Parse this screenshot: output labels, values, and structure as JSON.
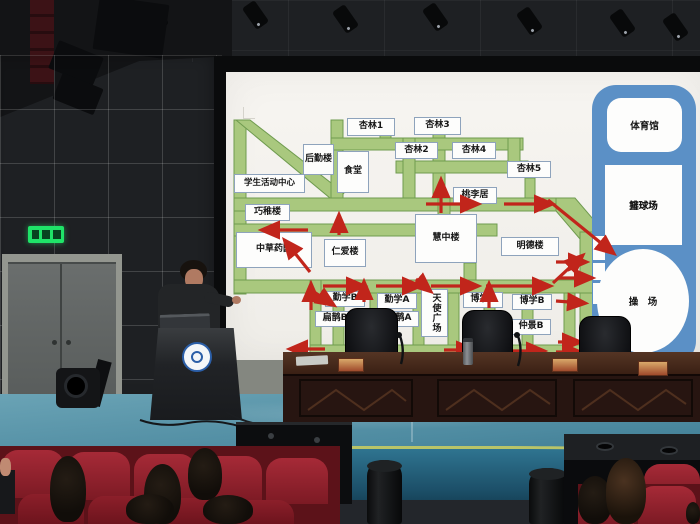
{
  "colors": {
    "road": "#a9c87e",
    "road_border": "#6f9b4f",
    "route_arrow": "#c1251b",
    "sports_panel_blue": "#5b90c6",
    "label_border": "#8ea3bc",
    "exit_sign_green": "#1fe468",
    "seat_red": "#92202b",
    "stage_floor_blue": "#4d8aa0",
    "screen_white": "#f4f2ee"
  },
  "map": {
    "buildings": [
      {
        "name": "xinglin-1",
        "label": "杏林1"
      },
      {
        "name": "xinglin-3",
        "label": "杏林3"
      },
      {
        "name": "xinglin-2",
        "label": "杏林2"
      },
      {
        "name": "xinglin-4",
        "label": "杏林4"
      },
      {
        "name": "xinglin-5",
        "label": "杏林5"
      },
      {
        "name": "houqin-building",
        "label": "后勤楼"
      },
      {
        "name": "canteen",
        "label": "食堂"
      },
      {
        "name": "student-activity-center",
        "label": "学生活动中心"
      },
      {
        "name": "qiaozhi-building",
        "label": "巧稚楼"
      },
      {
        "name": "herb-garden",
        "label": "中草药园"
      },
      {
        "name": "renai-building",
        "label": "仁爱楼"
      },
      {
        "name": "huizhong-building",
        "label": "慧中楼"
      },
      {
        "name": "taoli-ju",
        "label": "桃李居"
      },
      {
        "name": "mingde-building",
        "label": "明德楼"
      },
      {
        "name": "qinxue-b",
        "label": "勤学B"
      },
      {
        "name": "qinxue-a",
        "label": "勤学A"
      },
      {
        "name": "angel-square",
        "label": "天使广场"
      },
      {
        "name": "boxue-a",
        "label": "博学A"
      },
      {
        "name": "boxue-b",
        "label": "博学B"
      },
      {
        "name": "bianque-b",
        "label": "扁鹊B"
      },
      {
        "name": "bianque-a",
        "label": "扁鹊A"
      },
      {
        "name": "zhongjing-b",
        "label": "仲景B"
      }
    ],
    "sports": {
      "gym": "体育馆",
      "volleyball": "排球场",
      "basketball": "篮球场",
      "field": "操　场"
    }
  },
  "icons": {
    "exit_sign": "emergency-exit-running-man",
    "school_logo": "round-blue-university-emblem"
  }
}
